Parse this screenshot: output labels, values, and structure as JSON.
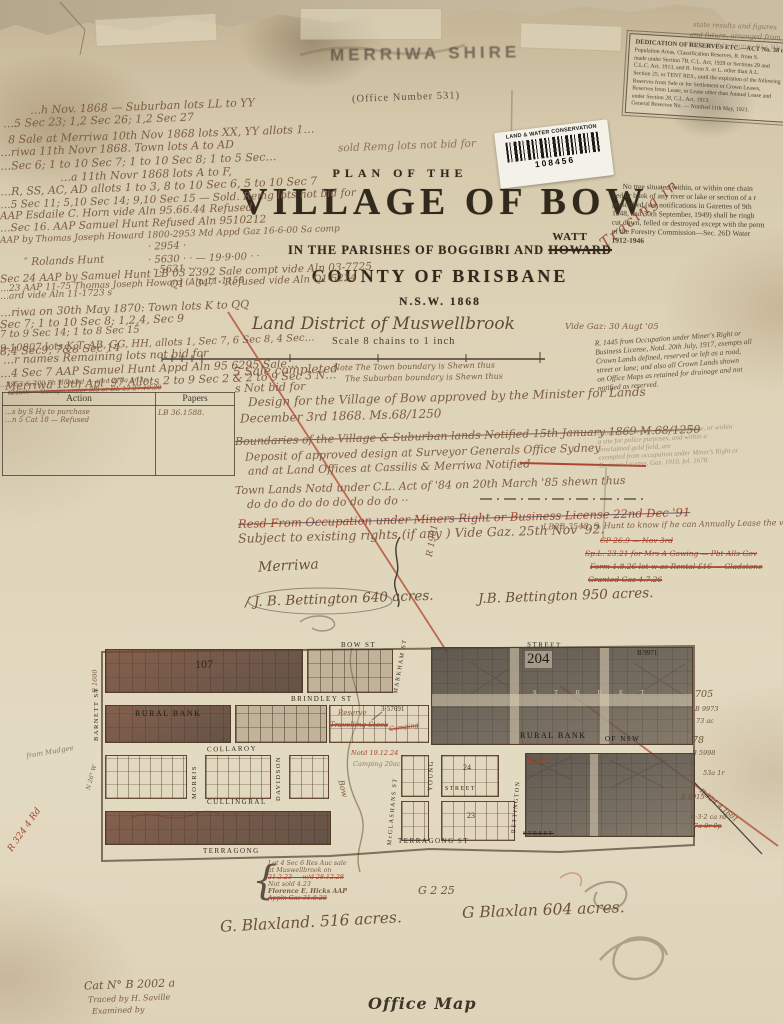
{
  "colors": {
    "wall": "#b5a78c",
    "paper": "#ddd2b6",
    "title_ink": "#32291d",
    "hand_ink": "#7c5c43",
    "red_ink": "#a7442e",
    "dark_block": "#55504a"
  },
  "stamps": {
    "shire": "MERRIWA SHIRE",
    "office_number": "(Office Number 531)",
    "tracing": "Tracing in"
  },
  "sticker": {
    "dept": "LAND & WATER CONSERVATION",
    "number": "108456"
  },
  "title": {
    "plan_of_the": "PLAN OF THE",
    "village": "VILLAGE OF BOW",
    "parishes_prefix": "IN THE PARISHES OF BOGGIBRI AND",
    "parish_struck": "HOWARD",
    "parish_correction": "WATT",
    "county": "COUNTY OF BRISBANE",
    "state_year": "N.S.W. 1868",
    "district": "Land District of Muswellbrook",
    "district_gaz": "Vide Gaz: 30 Augt '05",
    "scale": "Scale 8 chains to 1 inch"
  },
  "top_notes": {
    "sold": "sold  Remg lots not bid for",
    "corner0": "state results and figures",
    "corner1": "and future, arranged from",
    "corner2": "W.R. or R.L. Comp. 91a Wal"
  },
  "left_notes": {
    "lines": [
      "…h Nov. 1868 —  Suburban lots LL to YY",
      "…5 Sec 23;  1,2 Sec 26;  1,2 Sec 27",
      "8 Sale at Merriwa  10th Nov 1868 lots XX, YY allots 1…",
      "…riwa 11th Novr 1868.  Town lots A to AD",
      "…Sec 6; 1 to 10 Sec 7; 1 to 10 Sec 8; 1 to 5 Sec…",
      "…a  11th Novr 1868  lots A to F,",
      "…R, SS, AC, AD  allots 1 to 3, 8 to 10 Sec 6, 5 to 10 Sec 7",
      "…5 Sec 11; 5,10 Sec 14; 9,10 Sec 15 — Sold.  Remg lots not bid for",
      "AAP Esdaile C. Horn vide Aln 95.66.44  Refused",
      "…Sec 16.  AAP Samuel Hunt  Refused  Aln 9510212",
      "AAP by Thomas Joseph Howard 1800-2953 Md Appd Gaz 16-6-00 Sa comp",
      "·  2954  ·",
      "·  5630 · ·    — 19·9·00 · ·",
      "·  5631 · ·",
      "Q1 – 347 ·    Refused vide Aln Q1-5224",
      "″  Rolands  Hunt",
      "Sec 24 AAP by Samuel Hunt   LB 03 2392 Sale compt vide Aln 03-7725",
      "…23 AAP 11-75 Thomas Joseph Howard  (Aln 11-1150",
      "…ard vide Aln 11-1723 s",
      "…riwa  on 30th May 1870:  Town lots K to QQ",
      "Sec 7;  1 to 10 Sec 8;  1,2,4, Sec 9",
      "7 to 9 Sec 14;  1 to 8 Sec 15",
      "9-10807 lots K,T, AB, GG, HH, allots 1, Sec 7, 6 Sec 8, 4 Sec…",
      "…r names   Remaining lots not bid for",
      "…4 Sec 7 AAP Samuel Hunt  Appd Aln 95 6295  Sale…",
      "Merriwa 13th Apl '97   Allots 2 to 9 Sec 2 & 2 to 9 Sec 3  N…",
      "…2953 & 200 Ph Howard — area 216a 1r 3p",
      "(2460) —  Occupn under 9/8 or DL 13  27.10.30"
    ]
  },
  "center_notes": {
    "seg": "8;4 Sec9, 7&8 Sec 14",
    "sale_completed": "5 Sale completed",
    "not_bid": "s Not bid for",
    "note1": "Note  The Town boundary is Shewn thus",
    "note2": "The Suburban boundary is Shewn thus",
    "design1": "Design for the Village of Bow approved by the Minister for Lands",
    "design2": "December 3rd 1868. Ms.68/1250",
    "boundaries_struck": "Boundaries of the Village & Suburban lands Notified 15th January 1869 M.68/1250",
    "deposit1": "Deposit of approved design at Surveyor Generals Office Sydney",
    "deposit2": "and at Land Offices at Cassilis & Merriwa Notified",
    "town1": "Town Lands Notd under C.L. Act of '84 on 20th March '85 shewn thus",
    "town2": "do   do   do   do   do    do      do      do   do ··",
    "resd_struck": "Resd From Occupation under Miners Right or Business License 22nd Dec '91",
    "subject": "Subject to existing rights (if any ) Vide Gaz. 25th Nov '92."
  },
  "table": {
    "header_action": "Action",
    "header_papers": "Papers",
    "row_action1": "…s by S Hy to purchase",
    "row_action2": "…n 5 Cat 18 — Refused",
    "row_papers": "LB 36.1588."
  },
  "right_notices": {
    "dedication": {
      "title": "DEDICATION OF RESERVES ETC.—ACT No. 38 of",
      "lines": [
        "Population Areas, Classification Reserves, R. from S.",
        "made under Section 7B, C.L. Act, 1929 or Sections 29 and",
        "C.L.C. Act, 1913, and R. from S. or L. other than A.L.",
        "Section 25, or TENT RES., until the expiration of the following",
        "Reserves from Sale or for Settlement or Crown Leases,",
        "Reserves from Lease, or Lease other than Annual Lease and",
        "under Section 28, C.L. Act, 1913.",
        "General Reserves No. — Notified 11th May, 1921."
      ]
    },
    "tree": {
      "lines": [
        "No tree situated within, or within one chain",
        "bed or bank of any river or lake or section of a r",
        "prescribed (see notifications in Gazettes of 9th",
        "1948, and 30th September, 1949) shall be ringb",
        "cut down, felled or destroyed except with the perm",
        "of the Forestry Commission—Sec. 26D Water",
        "1912-1946"
      ]
    },
    "r1445": {
      "lines": [
        "R. 1445 from Occupation under Miner's Right or",
        "Business License, Notd. 20th July, 1917, exempts all",
        "Crown Lands defined, reserved or left as a road,",
        "street or lane; and also all Crown Lands shown",
        "on Office Maps as retained for drainage and not",
        "notified as reserved."
      ]
    },
    "crown": {
      "lines": [
        "Crown lands within a Town or Village, or within",
        "a site for police purposes, and within a",
        "proclaimed gold field, are",
        "exempted from occupation under Miner's Right or",
        "Business License, Gaz. 1910, fol. 1678."
      ]
    },
    "hunt_note": "LB3B-3548. S. Hunt to know if he can Annually Lease the vacant l…",
    "struck0": "CP 26.9 — Nov 3rd",
    "struck1": "Sp.L. 23.21 for Mrs A Gowing — Pbt Alls Gov",
    "struck2": "Form 1.8.26 lot w as Rental £16 — Gladstone",
    "struck3": "Granted Gaz 4.7.26"
  },
  "estates": {
    "merriwa": "Merriwa",
    "bettington_640": "/ J. B. Bettington  640 acres.",
    "bettington_950": "J.B. Bettington 950 acres.",
    "r1901": "R 1901",
    "g225": "G 2 25",
    "blaxland_516": "G. Blaxland.  516 acres.",
    "blaxland_604": "G Blaxlan  604 acres.",
    "hicks": [
      "Lot 4 Sec 6 Res Auc sale",
      "at Muswellbrook on",
      "21.2.23 — w/d 28.12.28",
      "Not sold 4.23",
      "Florence E. Hicks AAP",
      "Appln Gaz 31.8.28"
    ],
    "brace": "{"
  },
  "map": {
    "streets": {
      "bow": "BOW  ST",
      "street_top": "STREET",
      "brindley": "BRINDLEY  ST",
      "collaroy": "COLLAROY",
      "cullingral": "CULLINGRAL",
      "terragong": "TERRAGONG",
      "terragong_st": "TERRAGONG  ST",
      "street_mid": "STREET",
      "street_struck": "STREET",
      "street_spread": "S T R E E T",
      "barnett": "BARNETT ST",
      "morris": "MORRIS",
      "davidson": "DAVIDSON",
      "mcglashans": "McGLASHANS ST",
      "young": "YOUNG",
      "markham": "MARKHAM ST",
      "bettington": "BETTINGTON"
    },
    "sections": {
      "s107": "107",
      "s204": "204",
      "lot24": "24",
      "lot23": "23"
    },
    "labels": {
      "rural_bank": "RURAL BANK",
      "bradley": "W. J. Bradley",
      "rural_bank2": "RURAL BANK",
      "of_nsw": "OF NSW",
      "reserve": "Reserve",
      "travelling": "Travelling Stock",
      "camping": "Camping",
      "measure": "3·57691",
      "notd": "Notd 19.12.24",
      "camping_res": "Camping 20ac",
      "pt_ocp": "Pt OCP",
      "b9971": "B 9971",
      "bow_creek": "Bow"
    },
    "margin_right": [
      "705",
      "B 9973",
      "73 ac",
      "78",
      "B 5998",
      "53a 1r",
      "B 9915",
      "6·3·2 ca rd",
      "7a 0r 0p"
    ],
    "margin_left": {
      "r1600": "R 1600",
      "n26w": "N 26° W",
      "from_mudgee": "from Mudgee",
      "r324": "R 324 4 Rd"
    },
    "r324_diag": "R.324.4.1601"
  },
  "footer": {
    "cat_no": "Cat N° B 2002 a",
    "traced_by": "Traced by   H. Saville",
    "examined_by": "Examined by",
    "office_map": "Office Map"
  }
}
